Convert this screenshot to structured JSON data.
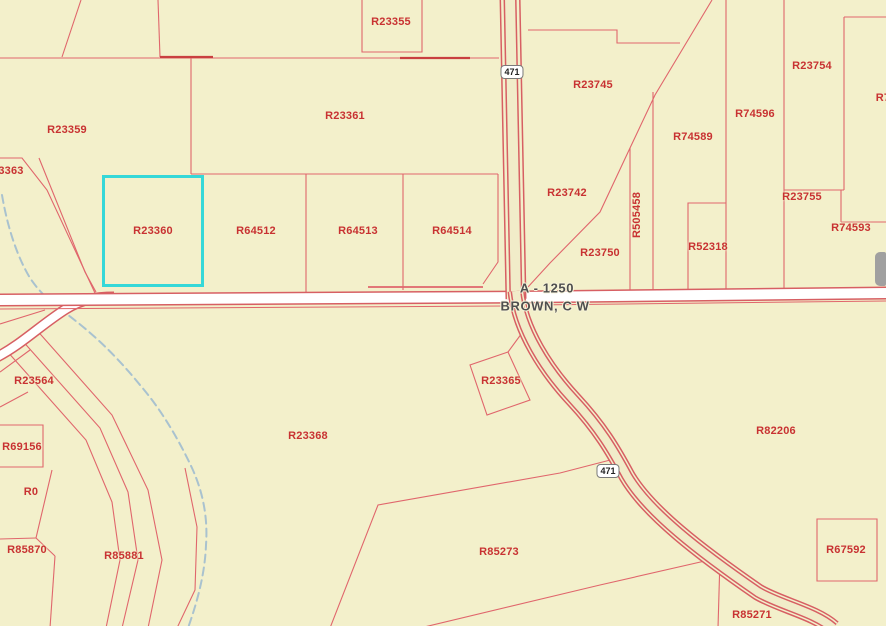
{
  "map": {
    "colors": {
      "background": "#f3f0cb",
      "parcel_line": "#e0666c",
      "road_casing": "#d75f63",
      "parcel_label": "#c83232",
      "highlight": "#35d8d8",
      "road_label": "#4f4f4f",
      "stream": "#a9c2cf",
      "scroll_thumb": "#a0a0a0",
      "road_fill_tan": "#f1ecc9"
    },
    "road": {
      "name_line1": "A - 1250",
      "name_line2": "BROWN, C W"
    },
    "shields": [
      {
        "label": "471"
      },
      {
        "label": "471"
      }
    ],
    "highlighted_parcel": {
      "id": "R23360"
    },
    "parcels": [
      {
        "id": "R23355"
      },
      {
        "id": "R23359"
      },
      {
        "id": "3363"
      },
      {
        "id": "R23361"
      },
      {
        "id": "R23745"
      },
      {
        "id": "R23754"
      },
      {
        "id": "R74596"
      },
      {
        "id": "R74589"
      },
      {
        "id": "R7"
      },
      {
        "id": "R23742"
      },
      {
        "id": "R23360"
      },
      {
        "id": "R64512"
      },
      {
        "id": "R64513"
      },
      {
        "id": "R64514"
      },
      {
        "id": "R505458"
      },
      {
        "id": "R23750"
      },
      {
        "id": "R52318"
      },
      {
        "id": "R23755"
      },
      {
        "id": "R74593"
      },
      {
        "id": "R23564"
      },
      {
        "id": "R69156"
      },
      {
        "id": "R0"
      },
      {
        "id": "R85870"
      },
      {
        "id": "R85881"
      },
      {
        "id": "R23368"
      },
      {
        "id": "R23365"
      },
      {
        "id": "R82206"
      },
      {
        "id": "R85273"
      },
      {
        "id": "R67592"
      },
      {
        "id": "R85271"
      }
    ]
  }
}
